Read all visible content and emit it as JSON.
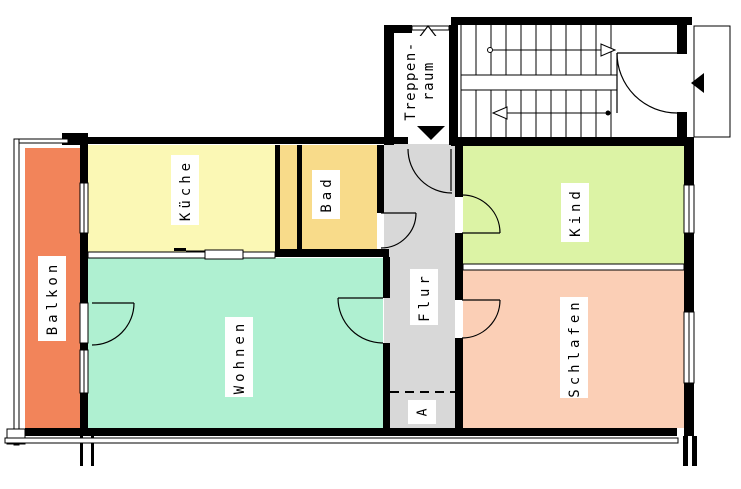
{
  "plan": {
    "rooms": {
      "balkon": {
        "label": "Balkon",
        "color": "#f2845a"
      },
      "kueche": {
        "label": "Küche",
        "color": "#fbf8b5"
      },
      "bad": {
        "label": "Bad",
        "color": "#f8db8a"
      },
      "wohnen": {
        "label": "Wohnen",
        "color": "#aff0d1"
      },
      "flur": {
        "label": "Flur",
        "color": "#d8d8d8"
      },
      "kind": {
        "label": "Kind",
        "color": "#dcf3a5"
      },
      "schlafen": {
        "label": "Schlafen",
        "color": "#fbcfb6"
      }
    },
    "hallway_storage": {
      "label": "A"
    },
    "stairwell": {
      "label_line1": "Treppen-",
      "label_line2": "raum"
    },
    "colors": {
      "wall": "#000000",
      "background": "#ffffff",
      "label_bg": "#ffffff"
    }
  }
}
